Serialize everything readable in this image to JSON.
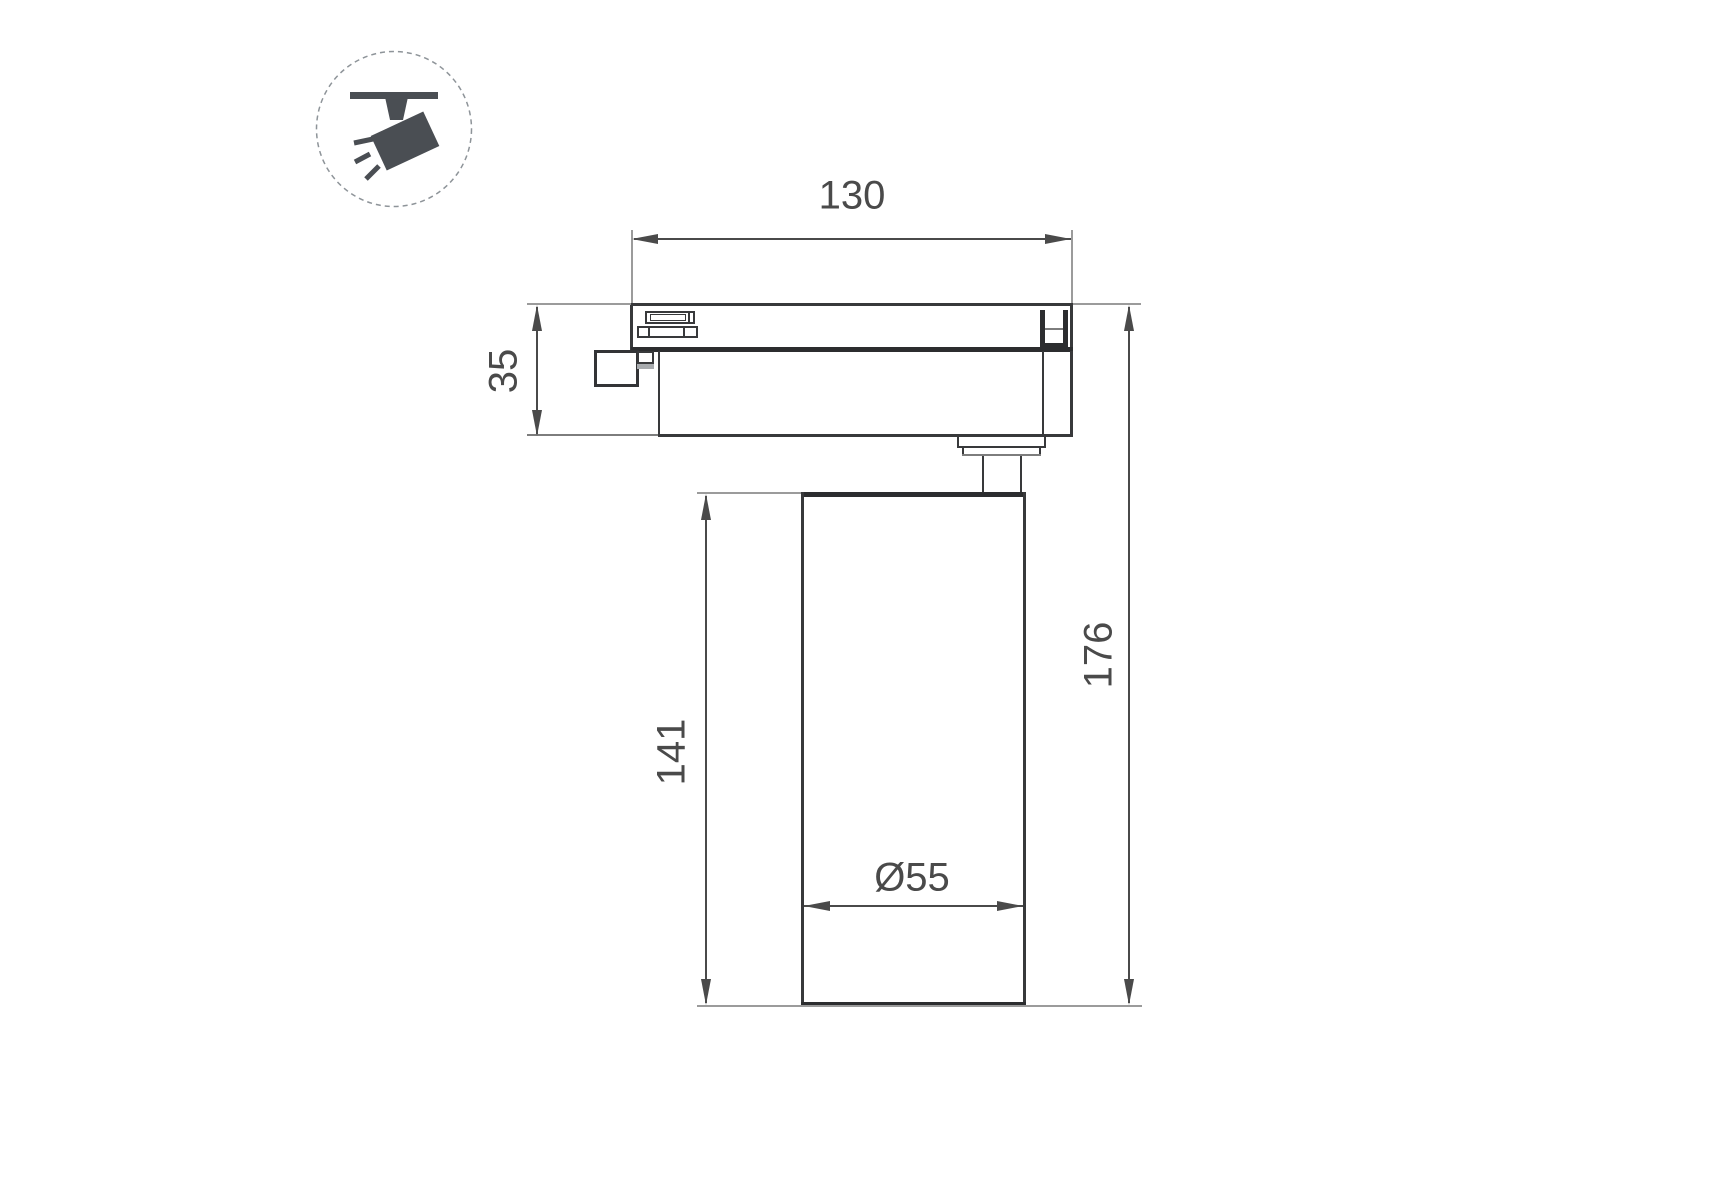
{
  "drawing": {
    "type": "technical-dimension-drawing",
    "subject": "track-mounted spotlight, side view",
    "dimensions": {
      "track_adapter_width": "130",
      "track_adapter_height": "35",
      "lamp_body_height": "141",
      "total_height": "176",
      "lamp_body_diameter": "Ø55"
    },
    "icon": {
      "name": "track-spotlight-icon",
      "description": "spotlight hanging from ceiling track inside dashed circle"
    },
    "colors": {
      "background": "#ffffff",
      "outline": "#38393b",
      "outline_bold": "#2c2d2f",
      "dimension_lines": "#4a4a4a",
      "extension_lines": "#9b9b9b",
      "icon_fill": "#4a4e53",
      "icon_circle": "#8e9499"
    }
  }
}
